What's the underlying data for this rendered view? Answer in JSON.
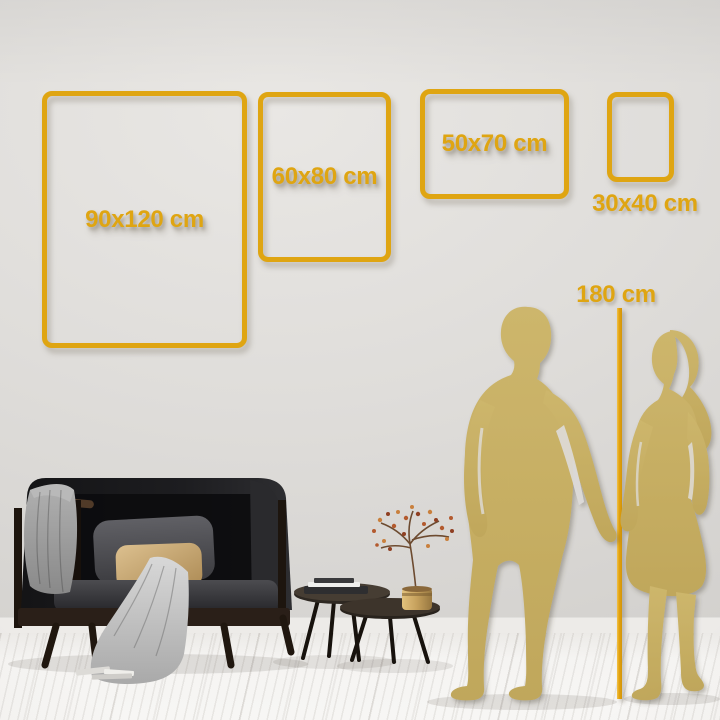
{
  "frames": [
    {
      "id": "90x120",
      "label": "90x120 cm"
    },
    {
      "id": "60x80",
      "label": "60x80 cm"
    },
    {
      "id": "50x70",
      "label": "50x70 cm"
    },
    {
      "id": "30x40",
      "label": "30x40 cm"
    }
  ],
  "height_reference": {
    "label": "180 cm"
  },
  "colors": {
    "accent_gold": "#DFA512",
    "silhouette_gold": "#C8B165",
    "line_gold": "#E2A10C"
  },
  "icons": {
    "man": "man-silhouette",
    "woman": "woman-silhouette",
    "height_line": "height-reference-line",
    "sofa": "sofa-illustration",
    "tables": "coffee-tables-illustration",
    "vase": "vase-illustration"
  }
}
